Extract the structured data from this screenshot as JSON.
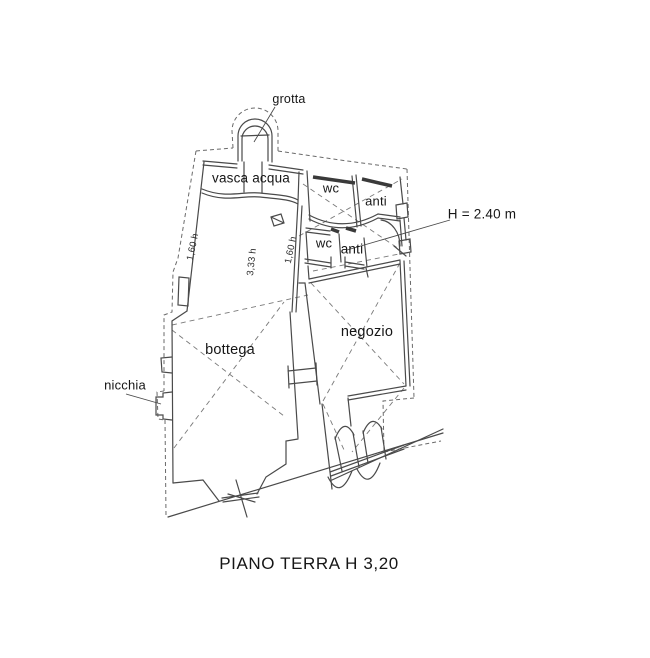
{
  "colors": {
    "background": "#ffffff",
    "line": "#4a4a4a",
    "dashed_boundary": "#6a6a6a",
    "text": "#161616"
  },
  "floor_plan": {
    "title": "PIANO TERRA H 3,20",
    "labels": {
      "grotta": "grotta",
      "vasca_acqua": "vasca acqua",
      "wc_upper": "wc",
      "anti_upper": "anti",
      "height_note": "H = 2.40 m",
      "wc_lower": "wc",
      "anti_lower": "anti",
      "bottega": "bottega",
      "negozio": "negozio",
      "nicchia": "nicchia"
    },
    "dimensions": {
      "left_height": "1,60 h",
      "center_height": "3,33 h",
      "right_height": "1,60 h"
    }
  }
}
